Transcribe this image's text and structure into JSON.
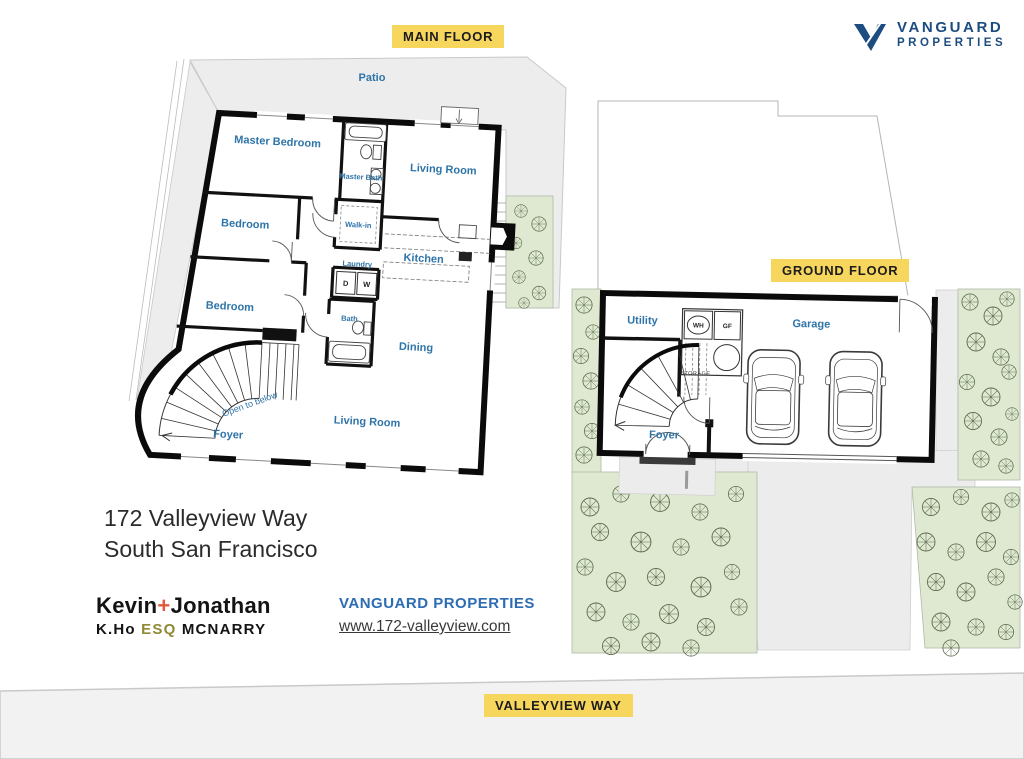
{
  "floor_tags": {
    "main": "MAIN FLOOR",
    "ground": "GROUND FLOOR",
    "street": "VALLEYVIEW WAY"
  },
  "logo": {
    "line1": "VANGUARD",
    "line2": "PROPERTIES"
  },
  "main_floor": {
    "patio": "Patio",
    "master_bedroom": "Master Bedroom",
    "master_bath": "Master Bath",
    "living_room_upper": "Living Room",
    "walk_in": "Walk-in",
    "bedroom_mid": "Bedroom",
    "kitchen": "Kitchen",
    "bedroom_lower": "Bedroom",
    "laundry": "Laundry",
    "dryer": "D",
    "washer": "W",
    "bath": "Bath",
    "dining": "Dining",
    "open_to_below": "Open to below",
    "foyer": "Foyer",
    "living_room_main": "Living Room"
  },
  "ground_floor": {
    "utility": "Utility",
    "garage": "Garage",
    "water_heater": "WH",
    "gas_furnace": "GF",
    "storage": "STORAGE",
    "foyer": "Foyer"
  },
  "address": {
    "line1": "172 Valleyview Way",
    "line2": "South San Francisco"
  },
  "agents": {
    "first": "Kevin",
    "plus": "+",
    "second": "Jonathan",
    "broker": "K.Ho",
    "esq": "ESQ",
    "lastname": "MCNARRY"
  },
  "footer": {
    "company": "VANGUARD PROPERTIES",
    "website": "www.172-valleyview.com"
  },
  "colors": {
    "highlight_yellow": "#F7D65E",
    "room_label_blue": "#2E74A8",
    "brand_navy": "#1C4C80",
    "footer_blue": "#2D6CB3",
    "accent_orange": "#E2593B",
    "esq_olive": "#8F8A33",
    "garden_green": "#DFE9D2",
    "lot_gray": "#EDEDED"
  }
}
